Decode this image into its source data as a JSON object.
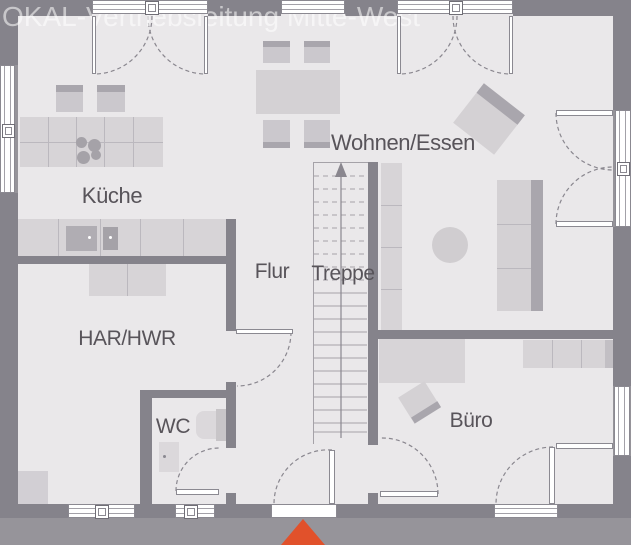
{
  "watermark": {
    "text": "OKAL-Vertriebsleitung Mitte-West"
  },
  "rooms": {
    "kueche": {
      "label": "Küche"
    },
    "wohnen_essen": {
      "label": "Wohnen/Essen"
    },
    "flur": {
      "label": "Flur"
    },
    "treppe": {
      "label": "Treppe"
    },
    "har_hwr": {
      "label": "HAR/HWR"
    },
    "wc": {
      "label": "WC"
    },
    "buero": {
      "label": "Büro"
    }
  },
  "markers": {
    "entrance_triangle": {
      "icon": "triangle-up",
      "color": "#e1512b"
    },
    "stairs_arrow": {
      "icon": "arrow-up",
      "direction": "up"
    }
  },
  "colors": {
    "outside": "#96949a",
    "wall": "#85838b",
    "floor": "#eae8ea",
    "furniture": "#d7d4d7",
    "furniture_dark": "#a9a6ad",
    "window": "#ffffff",
    "label_text": "#58545a",
    "accent_red": "#e1512b",
    "watermark_text": "rgba(255,255,255,0.55)"
  },
  "furniture_items": [
    "kitchen-bar-counter",
    "cooktop",
    "bar-stools",
    "kitchen-sink-counter",
    "dining-table",
    "dining-chairs",
    "armchair",
    "sofa",
    "coffee-table",
    "sideboard",
    "stairs",
    "office-desk",
    "office-chair",
    "office-shelf",
    "washer-dryer",
    "utility-unit",
    "toilet",
    "washbasin"
  ]
}
